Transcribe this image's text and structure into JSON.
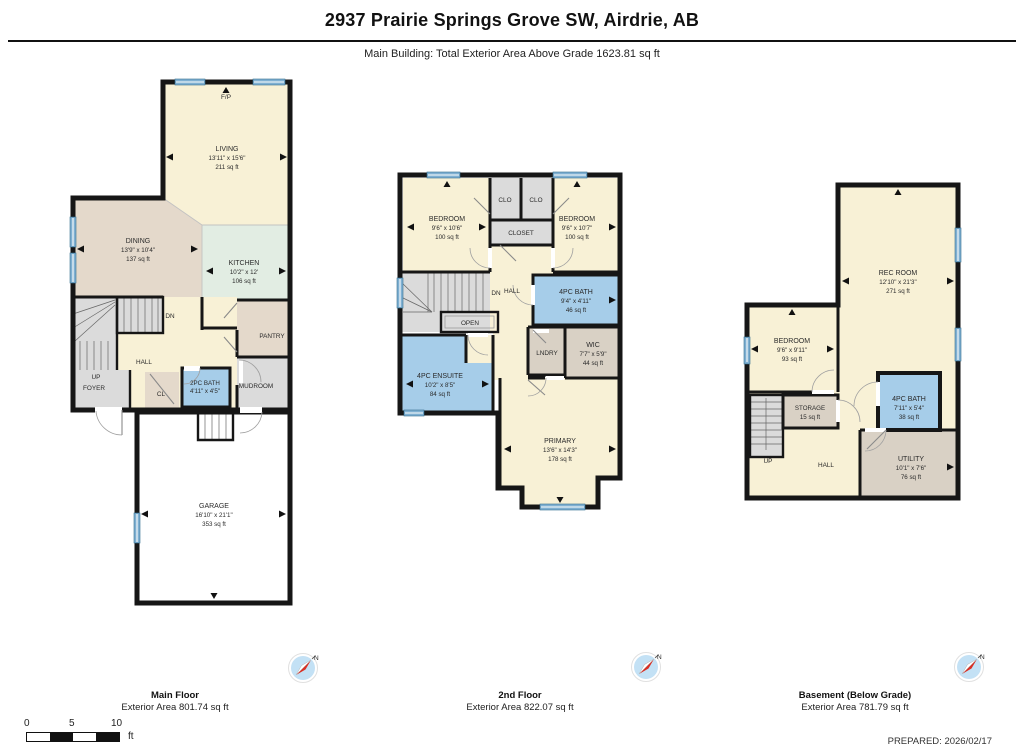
{
  "header": {
    "title": "2937 Prairie Springs Grove SW, Airdrie, AB",
    "subtitle": "Main Building: Total Exterior Area Above Grade 1623.81 sq ft"
  },
  "compass": {
    "n": "N"
  },
  "floors": [
    {
      "label": "Main Floor",
      "area_label": "Exterior Area 801.74 sq ft",
      "rooms": {
        "fp": {
          "name": "F/P"
        },
        "living": {
          "name": "LIVING",
          "dims": "13'11\" x 15'6\"",
          "area": "211 sq ft"
        },
        "dining": {
          "name": "DINING",
          "dims": "13'9\" x 10'4\"",
          "area": "137 sq ft"
        },
        "kitchen": {
          "name": "KITCHEN",
          "dims": "10'2\" x 12'",
          "area": "106 sq ft"
        },
        "pantry": {
          "name": "PANTRY"
        },
        "dn": {
          "name": "DN"
        },
        "hall": {
          "name": "HALL"
        },
        "up": {
          "name": "UP"
        },
        "foyer": {
          "name": "FOYER"
        },
        "cl": {
          "name": "CL"
        },
        "bath": {
          "name": "2PC BATH",
          "dims": "4'11\" x 4'5\""
        },
        "mudroom": {
          "name": "MUDROOM"
        },
        "garage": {
          "name": "GARAGE",
          "dims": "16'10\" x 21'1\"",
          "area": "353 sq ft"
        }
      }
    },
    {
      "label": "2nd Floor",
      "area_label": "Exterior Area 822.07 sq ft",
      "rooms": {
        "bedroom_left": {
          "name": "BEDROOM",
          "dims": "9'6\" x 10'6\"",
          "area": "100 sq ft"
        },
        "clo_left": {
          "name": "CLO"
        },
        "clo_right": {
          "name": "CLO"
        },
        "closet": {
          "name": "CLOSET"
        },
        "bedroom_right": {
          "name": "BEDROOM",
          "dims": "9'6\" x 10'7\"",
          "area": "100 sq ft"
        },
        "dn": {
          "name": "DN"
        },
        "hall": {
          "name": "HALL"
        },
        "open": {
          "name": "OPEN"
        },
        "bath": {
          "name": "4PC BATH",
          "dims": "9'4\" x 4'11\"",
          "area": "46 sq ft"
        },
        "laundry": {
          "name": "LNDRY"
        },
        "wic": {
          "name": "WIC",
          "dims": "7'7\" x 5'9\"",
          "area": "44 sq ft"
        },
        "ensuite": {
          "name": "4PC ENSUITE",
          "dims": "10'2\" x 8'5\"",
          "area": "84 sq ft"
        },
        "primary": {
          "name": "PRIMARY",
          "dims": "13'6\" x 14'3\"",
          "area": "178 sq ft"
        }
      }
    },
    {
      "label": "Basement (Below Grade)",
      "area_label": "Exterior Area 781.79 sq ft",
      "rooms": {
        "rec": {
          "name": "REC ROOM",
          "dims": "12'10\" x 21'3\"",
          "area": "271 sq ft"
        },
        "bedroom": {
          "name": "BEDROOM",
          "dims": "9'6\" x 9'11\"",
          "area": "93 sq ft"
        },
        "storage": {
          "name": "STORAGE",
          "area": "15 sq ft"
        },
        "up": {
          "name": "UP"
        },
        "hall": {
          "name": "HALL"
        },
        "bath": {
          "name": "4PC BATH",
          "dims": "7'11\" x 5'4\"",
          "area": "38 sq ft"
        },
        "utility": {
          "name": "UTILITY",
          "dims": "10'1\" x 7'6\"",
          "area": "76 sq ft"
        }
      }
    }
  ],
  "scale_bar": {
    "ticks": [
      "0",
      "5",
      "10"
    ],
    "unit": "ft"
  },
  "footer": {
    "prepared": "PREPARED: 2026/02/17"
  },
  "colors": {
    "room_cream": "#F8F1D6",
    "room_tan": "#E4D9CB",
    "room_mint": "#E2EDE3",
    "room_gray": "#DBDBDB",
    "room_taupe": "#D9D1C5",
    "room_blue": "#A6CDE9",
    "wall": "#161616",
    "window": "#7FB0D2"
  }
}
